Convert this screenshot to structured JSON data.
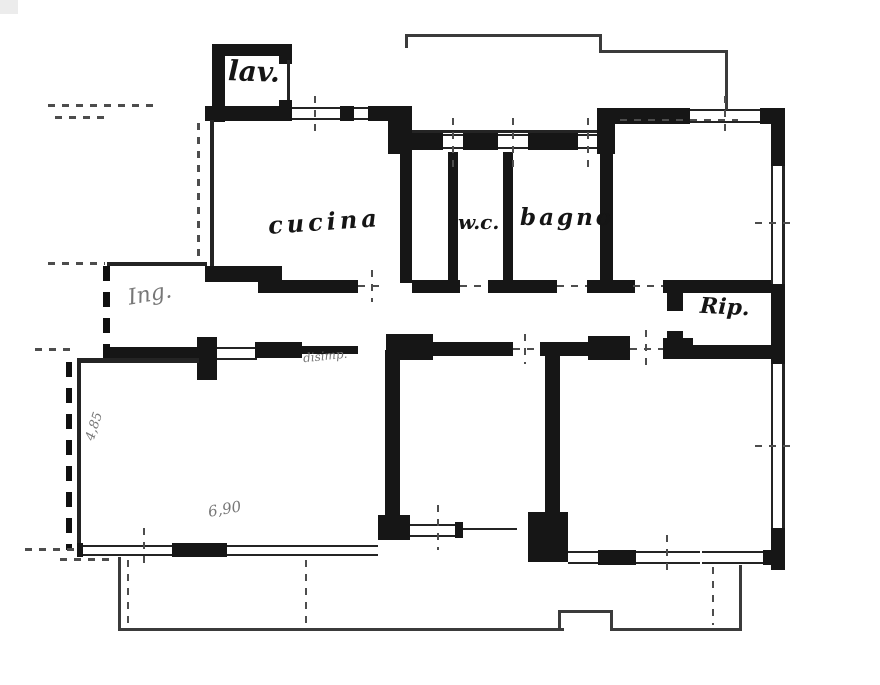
{
  "plan": {
    "type": "apartment-floor-plan",
    "rooms": {
      "lav": {
        "label": "lav."
      },
      "cucina": {
        "label": "cucina"
      },
      "wc": {
        "label": "w.c."
      },
      "bagno": {
        "label": "bagno"
      },
      "rip": {
        "label": "Rip."
      },
      "ing": {
        "label": "Ing."
      },
      "disimpegno": {
        "label": "disimp."
      }
    },
    "dimensions": {
      "left_wall": "4,85",
      "bottom_wall": "6,90"
    },
    "colors": {
      "ink": "#161616",
      "paper": "#ffffff",
      "faint_ink": "#777777"
    }
  }
}
